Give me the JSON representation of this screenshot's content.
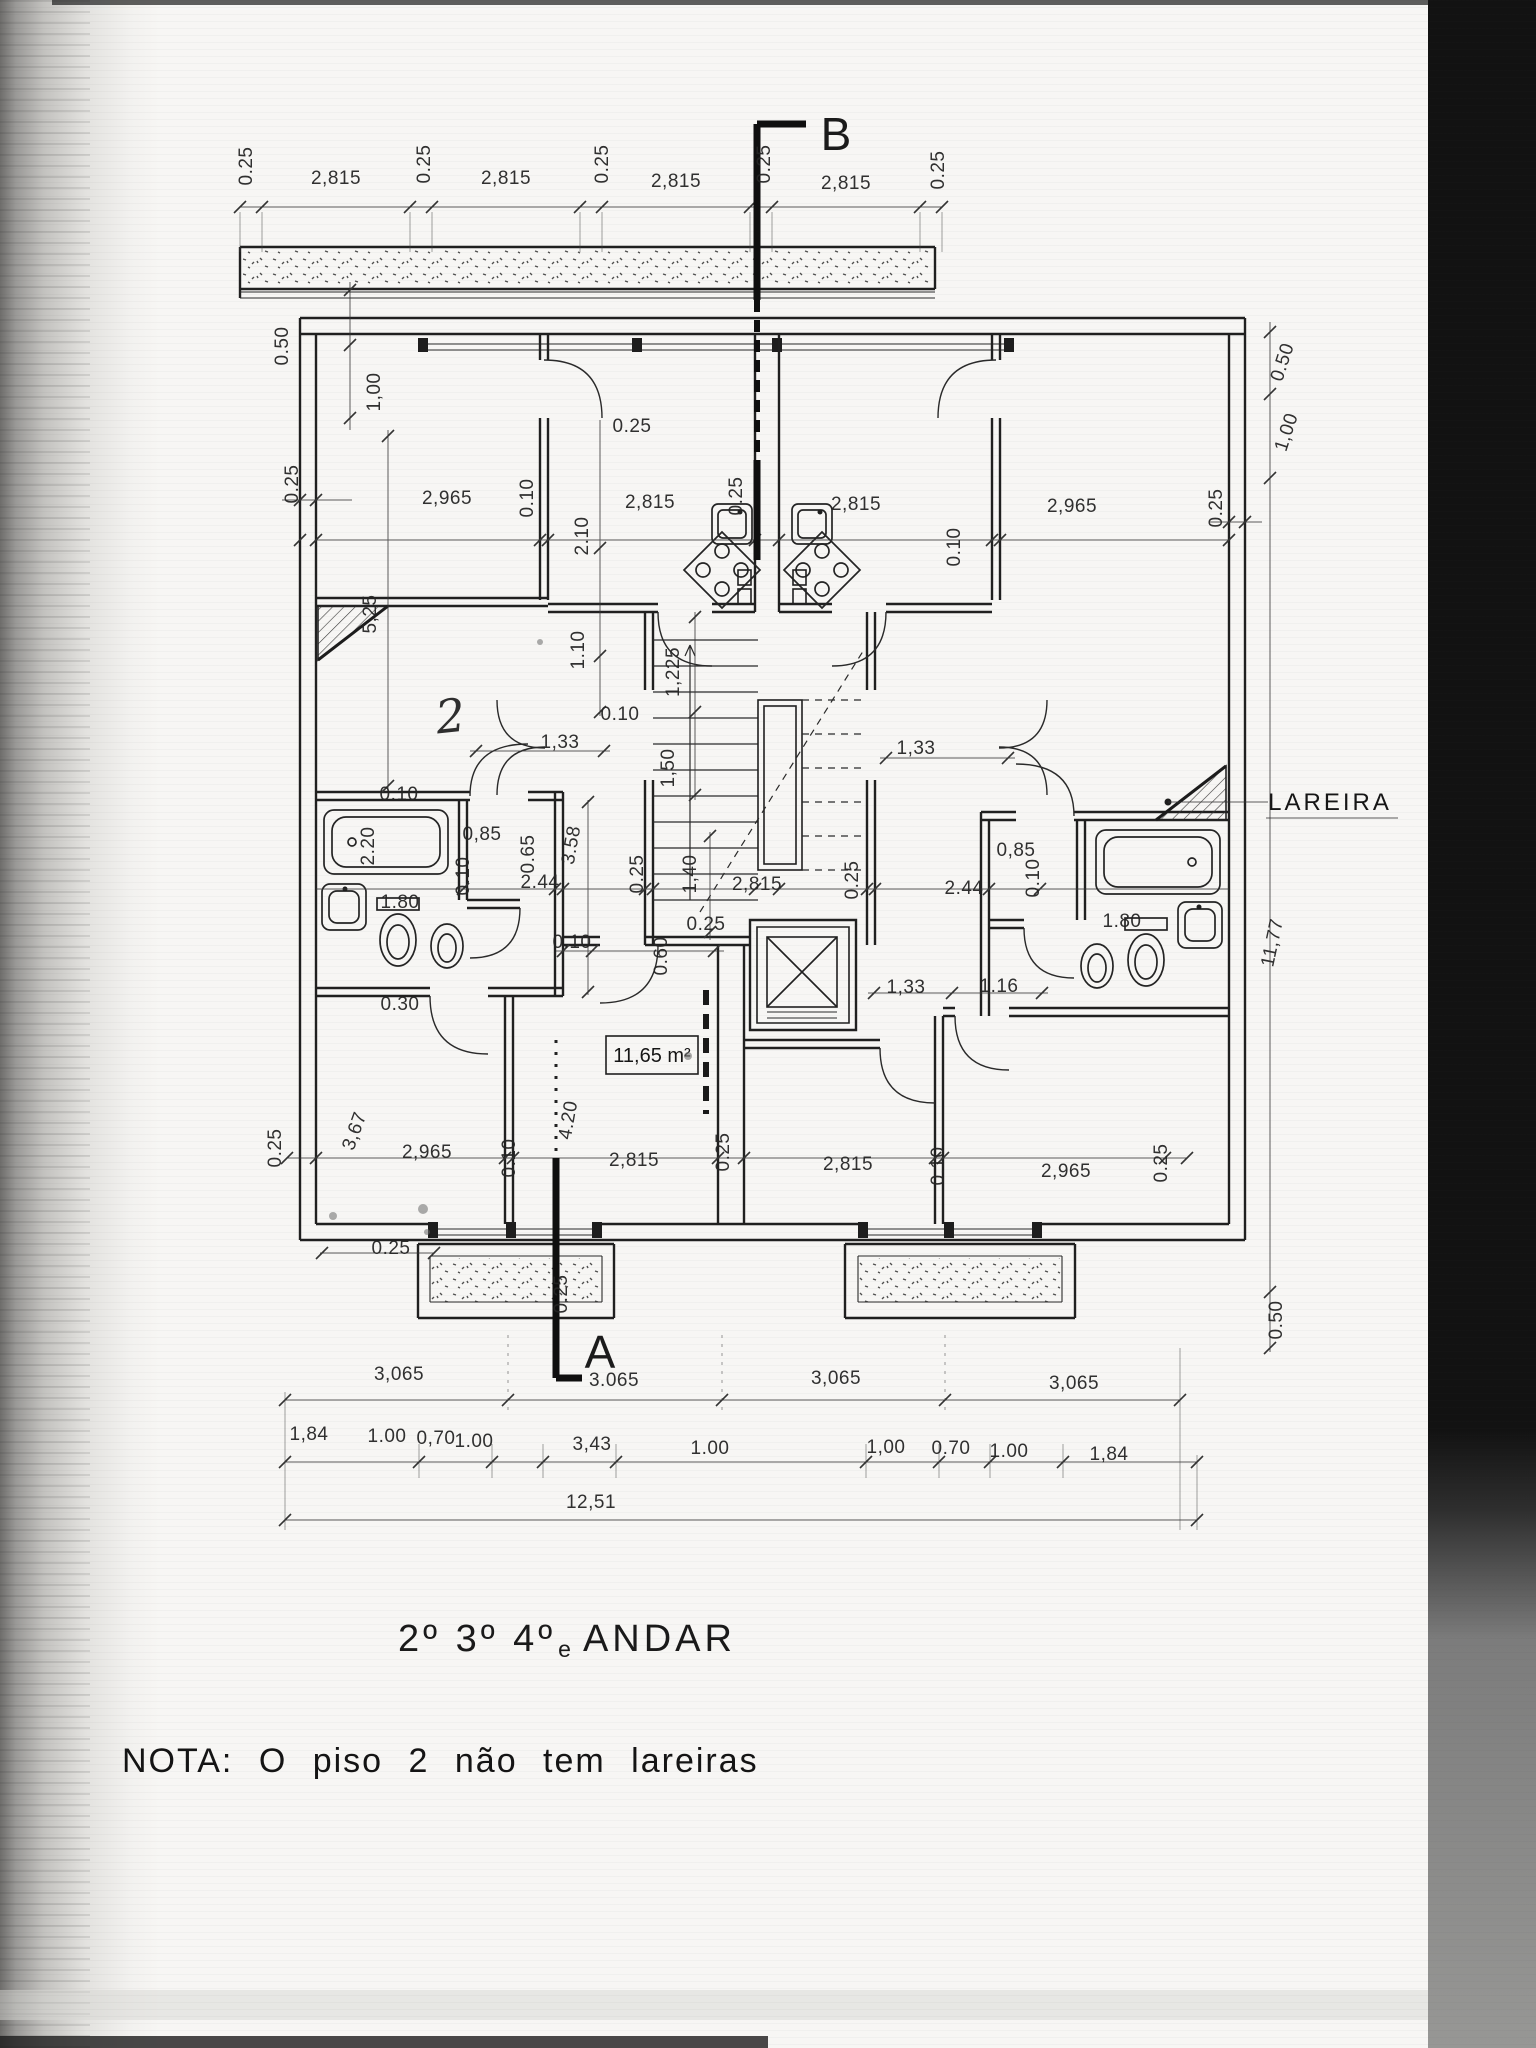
{
  "document": {
    "title": {
      "floors": "2º 3º 4º",
      "suffix": "e",
      "word": "ANDAR"
    },
    "note": "NOTA: O  piso 2  não  tem  lareiras"
  },
  "plan": {
    "section_marker_top": "B",
    "section_marker_bottom": "A",
    "fireplace_label": "LAREIRA",
    "room_area_label": "11,65 m²",
    "handwritten_mark": "2",
    "dim_labels": [
      {
        "t": "0.25",
        "x": 252,
        "y": 166,
        "r": -90
      },
      {
        "t": "2,815",
        "x": 336,
        "y": 184
      },
      {
        "t": "0.25",
        "x": 430,
        "y": 164,
        "r": -90
      },
      {
        "t": "2,815",
        "x": 506,
        "y": 184
      },
      {
        "t": "0.25",
        "x": 608,
        "y": 164,
        "r": -90
      },
      {
        "t": "2,815",
        "x": 676,
        "y": 187
      },
      {
        "t": "0.25",
        "x": 770,
        "y": 164,
        "r": -90
      },
      {
        "t": "2,815",
        "x": 846,
        "y": 189
      },
      {
        "t": "0.25",
        "x": 944,
        "y": 170,
        "r": -90
      },
      {
        "t": "0.50",
        "x": 288,
        "y": 346,
        "r": -90
      },
      {
        "t": "1,00",
        "x": 380,
        "y": 392,
        "r": -90
      },
      {
        "t": "0.50",
        "x": 1288,
        "y": 364,
        "r": -72
      },
      {
        "t": "1,00",
        "x": 1292,
        "y": 434,
        "r": -72
      },
      {
        "t": "0.25",
        "x": 298,
        "y": 484,
        "r": -90
      },
      {
        "t": "5,25",
        "x": 376,
        "y": 614,
        "r": -90
      },
      {
        "t": "0.25",
        "x": 1222,
        "y": 508,
        "r": -90
      },
      {
        "t": "11,77",
        "x": 1278,
        "y": 944,
        "r": -78
      },
      {
        "t": "0.50",
        "x": 1282,
        "y": 1320,
        "r": -90
      },
      {
        "t": "2,965",
        "x": 447,
        "y": 504
      },
      {
        "t": "0.10",
        "x": 533,
        "y": 498,
        "r": -90
      },
      {
        "t": "2,815",
        "x": 650,
        "y": 508
      },
      {
        "t": "0.25",
        "x": 742,
        "y": 496,
        "r": -90
      },
      {
        "t": "2,815",
        "x": 856,
        "y": 510
      },
      {
        "t": "0.10",
        "x": 960,
        "y": 547,
        "r": -90
      },
      {
        "t": "2,965",
        "x": 1072,
        "y": 512
      },
      {
        "t": "0.25",
        "x": 632,
        "y": 432
      },
      {
        "t": "2.10",
        "x": 588,
        "y": 536,
        "r": -90
      },
      {
        "t": "1.10",
        "x": 584,
        "y": 650,
        "r": -90
      },
      {
        "t": "0.10",
        "x": 620,
        "y": 720
      },
      {
        "t": "1,225",
        "x": 679,
        "y": 672,
        "r": -90
      },
      {
        "t": "1,33",
        "x": 560,
        "y": 748
      },
      {
        "t": "1,50",
        "x": 674,
        "y": 768,
        "r": -90
      },
      {
        "t": "1,33",
        "x": 916,
        "y": 754
      },
      {
        "t": "0.10",
        "x": 399,
        "y": 800
      },
      {
        "t": "2.20",
        "x": 374,
        "y": 846,
        "r": -90
      },
      {
        "t": "0,85",
        "x": 482,
        "y": 840
      },
      {
        "t": "0.65",
        "x": 534,
        "y": 854,
        "r": -90
      },
      {
        "t": "2.44",
        "x": 540,
        "y": 888
      },
      {
        "t": "0.10",
        "x": 469,
        "y": 876,
        "r": -90
      },
      {
        "t": "1.80",
        "x": 400,
        "y": 908
      },
      {
        "t": "0.30",
        "x": 400,
        "y": 1010
      },
      {
        "t": "3.58",
        "x": 577,
        "y": 846,
        "r": -80
      },
      {
        "t": "0.25",
        "x": 643,
        "y": 874,
        "r": -90
      },
      {
        "t": "1,40",
        "x": 696,
        "y": 874,
        "r": -90
      },
      {
        "t": "2,815",
        "x": 757,
        "y": 890
      },
      {
        "t": "0.25",
        "x": 858,
        "y": 880,
        "r": -90
      },
      {
        "t": "0.10",
        "x": 572,
        "y": 948
      },
      {
        "t": "0.60",
        "x": 667,
        "y": 956,
        "r": -90
      },
      {
        "t": "0.25",
        "x": 706,
        "y": 930
      },
      {
        "t": "1,33",
        "x": 906,
        "y": 993
      },
      {
        "t": "1.16",
        "x": 999,
        "y": 992
      },
      {
        "t": "0,85",
        "x": 1016,
        "y": 856
      },
      {
        "t": "2.44",
        "x": 964,
        "y": 894
      },
      {
        "t": "0.10",
        "x": 1039,
        "y": 878,
        "r": -90
      },
      {
        "t": "1.80",
        "x": 1122,
        "y": 927
      },
      {
        "t": "0.25",
        "x": 281,
        "y": 1148,
        "r": -90
      },
      {
        "t": "3,67",
        "x": 360,
        "y": 1133,
        "r": -70
      },
      {
        "t": "2,965",
        "x": 427,
        "y": 1158
      },
      {
        "t": "0.10",
        "x": 515,
        "y": 1158,
        "r": -90
      },
      {
        "t": "4.20",
        "x": 574,
        "y": 1121,
        "r": -80
      },
      {
        "t": "2,815",
        "x": 634,
        "y": 1166
      },
      {
        "t": "0.25",
        "x": 729,
        "y": 1152,
        "r": -90
      },
      {
        "t": "2,815",
        "x": 848,
        "y": 1170
      },
      {
        "t": "0.10",
        "x": 944,
        "y": 1166,
        "r": -90
      },
      {
        "t": "2,965",
        "x": 1066,
        "y": 1177
      },
      {
        "t": "0.25",
        "x": 1167,
        "y": 1163,
        "r": -90
      },
      {
        "t": "0.25",
        "x": 391,
        "y": 1254
      },
      {
        "t": "0.25",
        "x": 567,
        "y": 1294,
        "r": -90
      },
      {
        "t": "3,065",
        "x": 399,
        "y": 1380
      },
      {
        "t": "3.065",
        "x": 614,
        "y": 1386
      },
      {
        "t": "3,065",
        "x": 836,
        "y": 1384
      },
      {
        "t": "3,065",
        "x": 1074,
        "y": 1389
      },
      {
        "t": "1,84",
        "x": 309,
        "y": 1440
      },
      {
        "t": "1.00",
        "x": 387,
        "y": 1442
      },
      {
        "t": "0,70",
        "x": 436,
        "y": 1444
      },
      {
        "t": "1.00",
        "x": 474,
        "y": 1447
      },
      {
        "t": "3,43",
        "x": 592,
        "y": 1450
      },
      {
        "t": "1.00",
        "x": 710,
        "y": 1454
      },
      {
        "t": "1,00",
        "x": 886,
        "y": 1453
      },
      {
        "t": "0.70",
        "x": 951,
        "y": 1454
      },
      {
        "t": "1.00",
        "x": 1009,
        "y": 1457
      },
      {
        "t": "1,84",
        "x": 1109,
        "y": 1460
      },
      {
        "t": "12,51",
        "x": 591,
        "y": 1508
      }
    ]
  }
}
